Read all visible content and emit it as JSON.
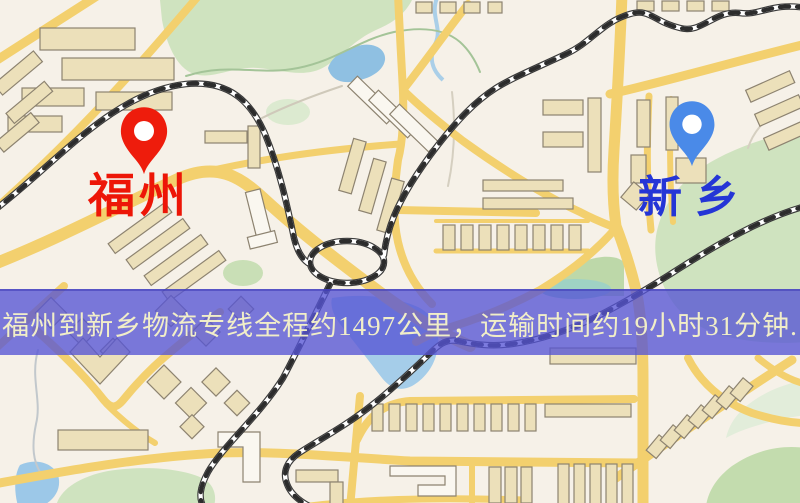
{
  "page": {
    "type": "logistics-route-map-image",
    "width_px": 800,
    "height_px": 503
  },
  "map": {
    "origin": {
      "label": "福州",
      "pin_icon": "red-map-pin",
      "pin_color": "#ee1c0c",
      "label_color": "#ed1607"
    },
    "destination": {
      "label": "新乡",
      "pin_icon": "blue-map-pin",
      "pin_color": "#4a8ae8",
      "label_color": "#2435d6"
    },
    "style": {
      "background": "#f6f1e8",
      "road": "#f3d06e",
      "building": "#ece0ba",
      "green_area": "#cfe3bf",
      "water": "#9cc8e8",
      "railway": "#2c2c2c"
    }
  },
  "banner": {
    "text": "福州到新乡物流专线全程约1497公里，运输时间约19小时31分钟.",
    "background": "#5654d5",
    "text_color": "#f1eec8",
    "distance_km": "1497",
    "duration_hours": "19",
    "duration_minutes": "31"
  }
}
